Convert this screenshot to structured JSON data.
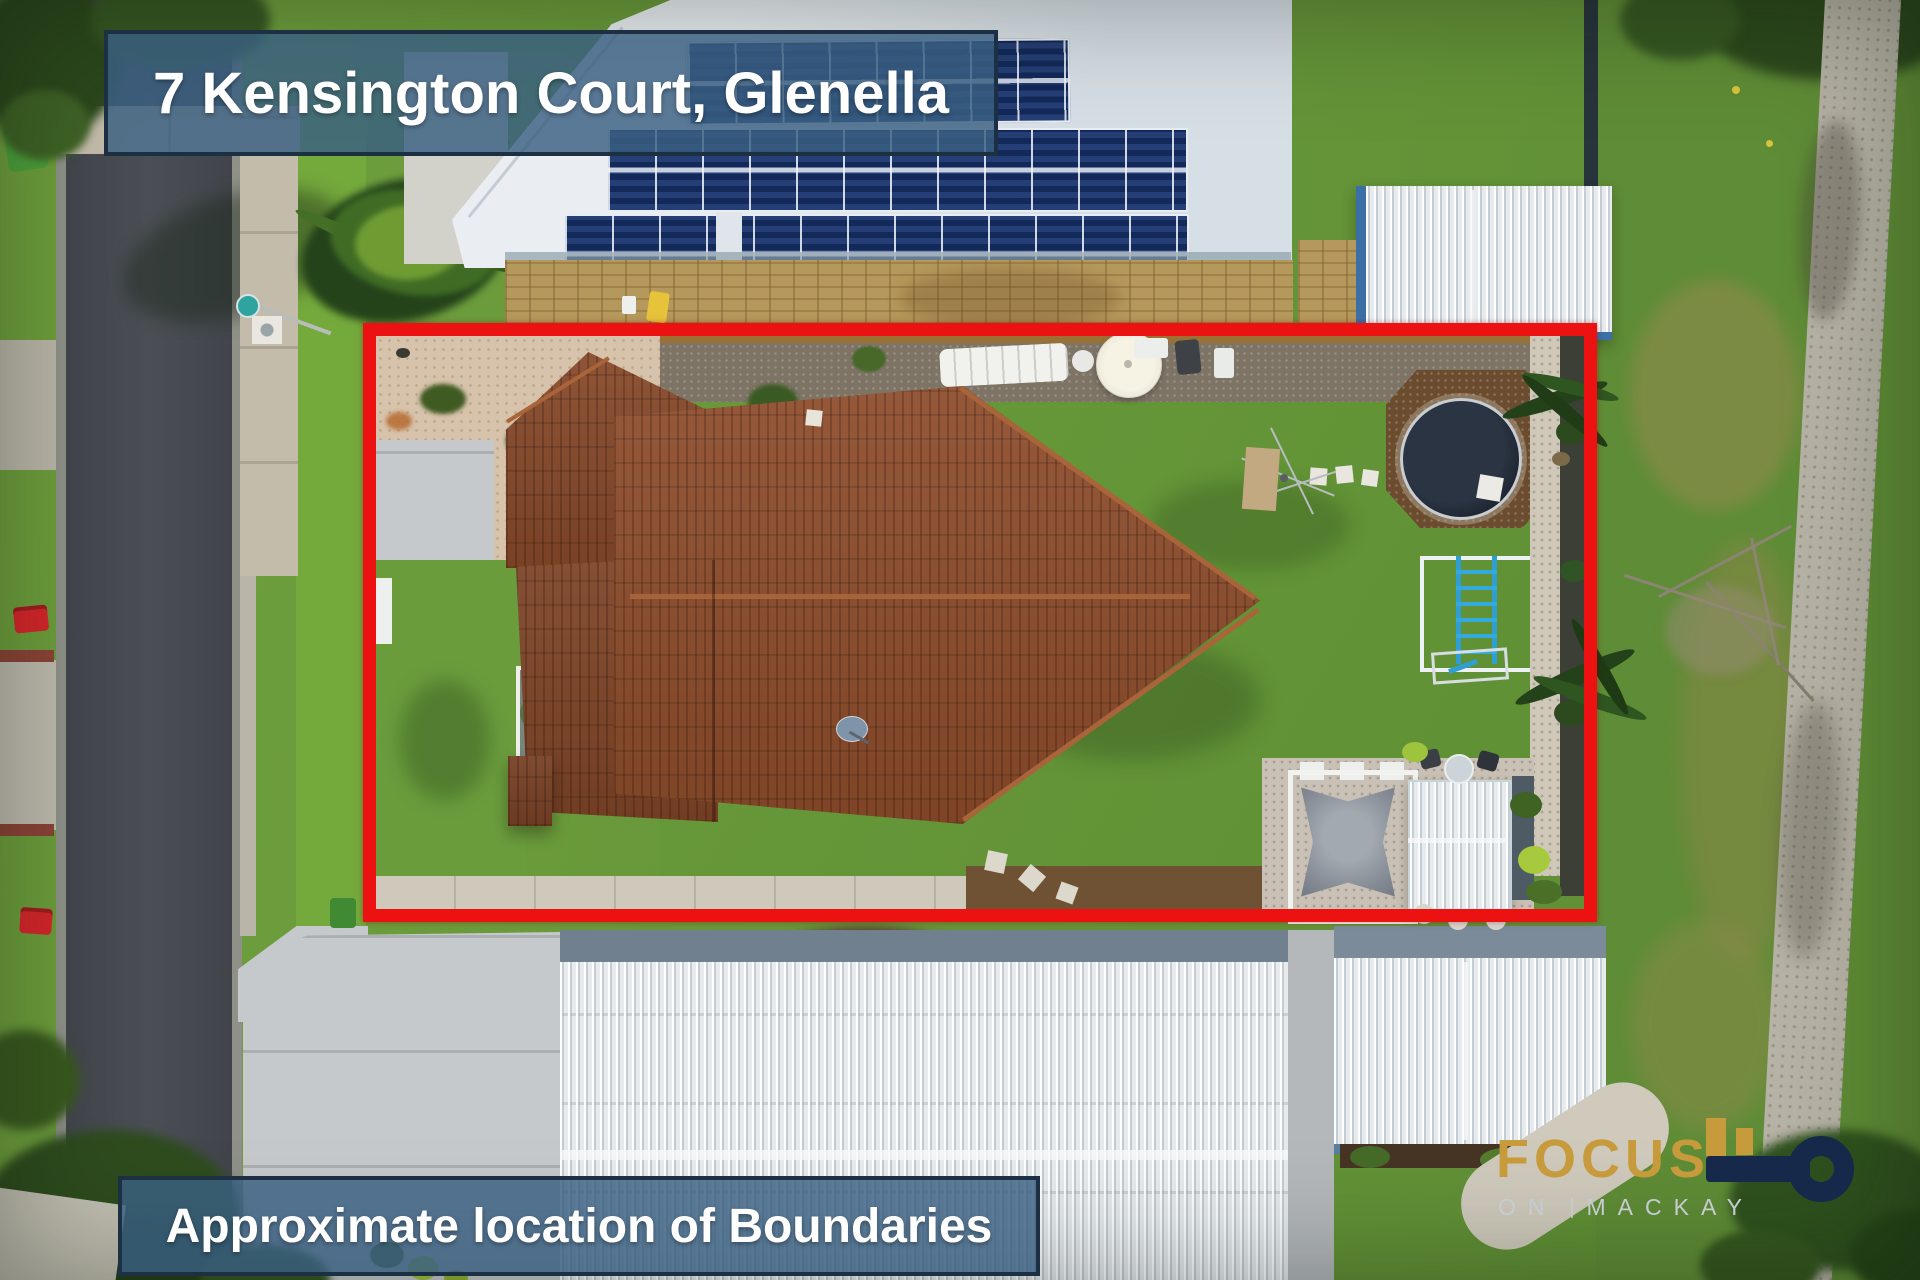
{
  "banners": {
    "title": "7 Kensington Court, Glenella",
    "subtitle": "Approximate location of Boundaries"
  },
  "logo": {
    "name": "FOCUS",
    "tagline_left": "ON",
    "tagline_right": "MACKAY",
    "key_icon": "key-icon"
  },
  "colors": {
    "boundary_red": "#EC1212",
    "banner_bg": "rgba(57,95,129,0.82)",
    "banner_border": "#1D2F42",
    "banner_text": "#FFFFFF",
    "logo_gold": "#C79A3B",
    "logo_navy": "#16294A",
    "logo_gray": "#C7CCD1"
  }
}
